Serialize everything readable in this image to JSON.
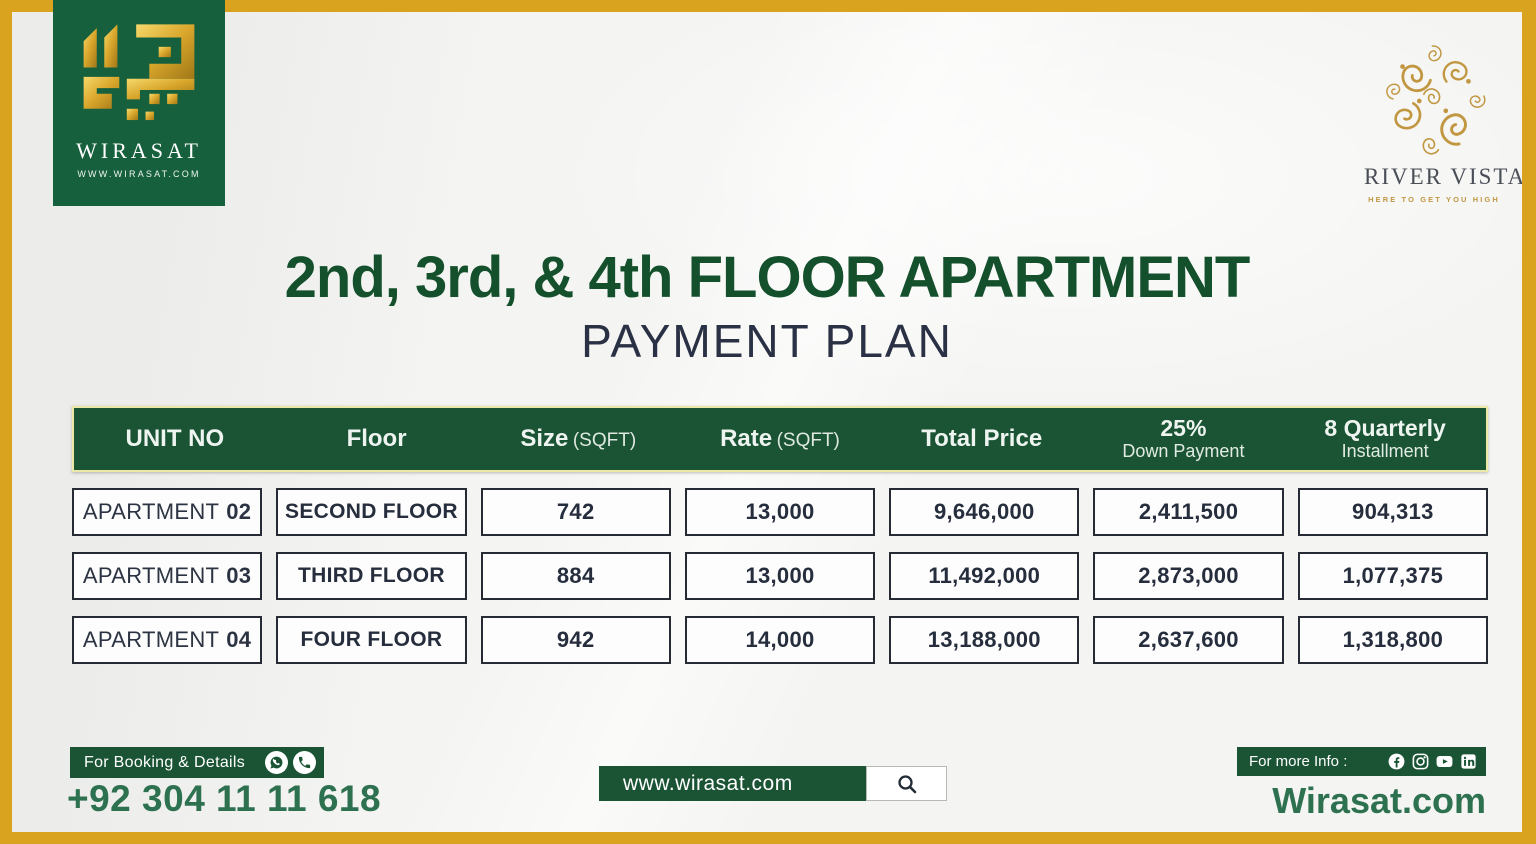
{
  "brand": {
    "wirasat_name": "WIRASAT",
    "wirasat_url": "WWW.WIRASAT.COM",
    "river_vista_name": "RIVER VISTA",
    "river_vista_tagline": "HERE TO GET YOU HIGH"
  },
  "title": {
    "line1": "2nd, 3rd, & 4th FLOOR APARTMENT",
    "line2": "PAYMENT PLAN"
  },
  "table": {
    "headers": {
      "unit": "UNIT NO",
      "floor": "Floor",
      "size": "Size",
      "size_unit": "(SQFT)",
      "rate": "Rate",
      "rate_unit": "(SQFT)",
      "total": "Total Price",
      "down_main": "25%",
      "down_sub": "Down Payment",
      "inst_main": "8 Quarterly",
      "inst_sub": "Installment"
    },
    "rows": [
      {
        "unit_label": "APARTMENT",
        "unit_no": "02",
        "floor": "SECOND FLOOR",
        "size": "742",
        "rate": "13,000",
        "total": "9,646,000",
        "down_payment": "2,411,500",
        "installment": "904,313"
      },
      {
        "unit_label": "APARTMENT",
        "unit_no": "03",
        "floor": "THIRD FLOOR",
        "size": "884",
        "rate": "13,000",
        "total": "11,492,000",
        "down_payment": "2,873,000",
        "installment": "1,077,375"
      },
      {
        "unit_label": "APARTMENT",
        "unit_no": "04",
        "floor": "FOUR FLOOR",
        "size": "942",
        "rate": "14,000",
        "total": "13,188,000",
        "down_payment": "2,637,600",
        "installment": "1,318,800"
      }
    ]
  },
  "footer": {
    "booking_label": "For Booking & Details",
    "phone": "+92 304 11 11 618",
    "website_bar": "www.wirasat.com",
    "info_label": "For more Info :",
    "website_text": "Wirasat.com"
  },
  "icons": [
    "whatsapp-icon",
    "phone-icon",
    "search-icon",
    "facebook-icon",
    "instagram-icon",
    "youtube-icon",
    "linkedin-icon"
  ],
  "colors": {
    "gold_border": "#d9a31f",
    "green_dark": "#1a5434",
    "logo_green": "#17603e",
    "title_green": "#14502c",
    "navy_text": "#2b3144",
    "accent_green_text": "#2d7150",
    "header_outline": "#ece9a8",
    "background": "#f4f4f2",
    "river_vista_gold": "#c19742"
  }
}
